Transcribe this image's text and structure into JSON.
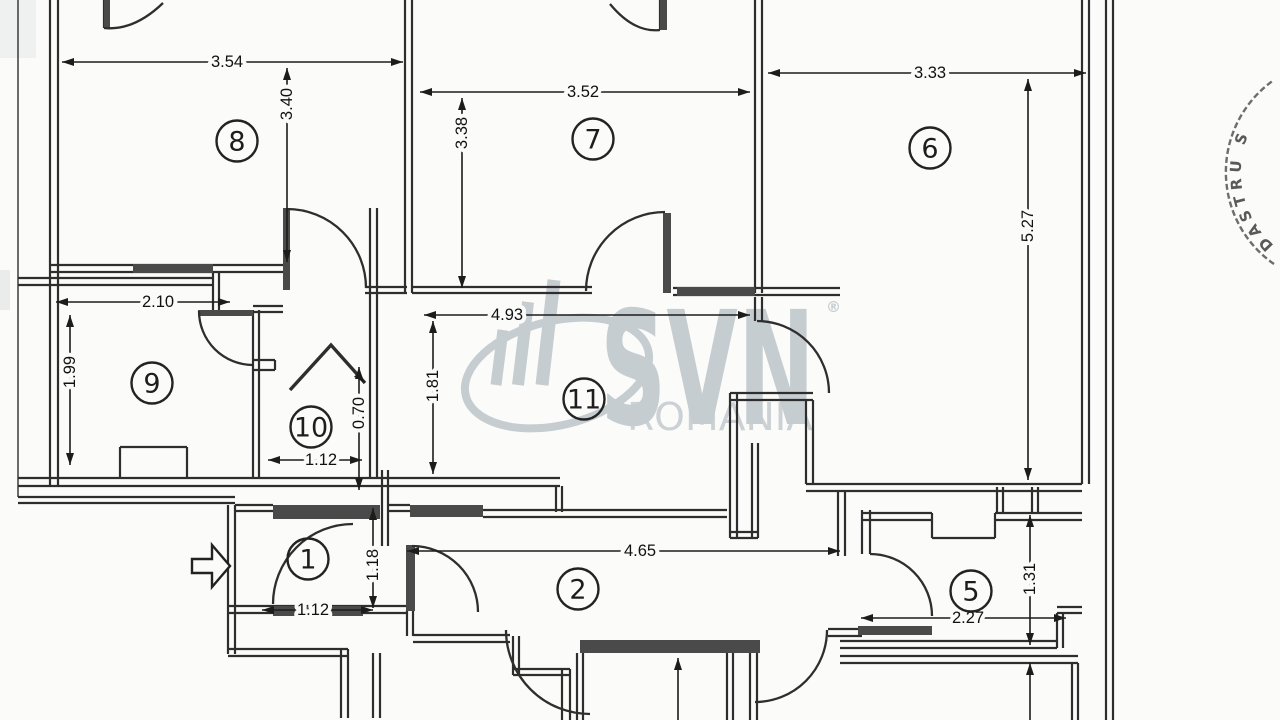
{
  "canvas": {
    "w": 1280,
    "h": 720,
    "bg": "#fbfbfa",
    "ink": "#2e2e2e"
  },
  "watermark": {
    "brand": "SVN",
    "reg": "®",
    "sub": "ROMANIA",
    "color": "#c6cdd0",
    "brand_x": 600,
    "brand_y": 424,
    "brand_size": 158,
    "brand_len": 215,
    "reg_x": 826,
    "reg_y": 312,
    "sub_x": 627,
    "sub_y": 430,
    "sub_size": 38,
    "sub_len": 186,
    "ellipse": {
      "cx": 557,
      "cy": 373,
      "rx": 94,
      "ry": 52,
      "rot": -14,
      "sw": 8
    },
    "bars": [
      [
        496,
        385,
        503,
        330,
        11
      ],
      [
        518,
        385,
        528,
        302,
        12
      ],
      [
        542,
        385,
        554,
        280,
        13
      ]
    ]
  },
  "stamp": {
    "text": "DASTRU S",
    "ring_d": "M1274,264 A112,112 0 0 1 1274,80",
    "text_d": "M1283,252 A97,97 0 0 1 1283,92",
    "color": "#4a4a4a"
  },
  "entry_arrow": {
    "d": "M192,559 L212,559 L212,545 L230,566 L212,587 L212,573 L192,573 Z"
  },
  "chevron": {
    "d": "M290,390 L331,345 L365,383"
  },
  "rooms": [
    {
      "n": "8",
      "x": 237,
      "y": 141
    },
    {
      "n": "7",
      "x": 593,
      "y": 139
    },
    {
      "n": "6",
      "x": 930,
      "y": 148
    },
    {
      "n": "9",
      "x": 152,
      "y": 383
    },
    {
      "n": "10",
      "x": 311,
      "y": 427
    },
    {
      "n": "11",
      "x": 584,
      "y": 399
    },
    {
      "n": "1",
      "x": 308,
      "y": 559
    },
    {
      "n": "2",
      "x": 578,
      "y": 589
    },
    {
      "n": "5",
      "x": 971,
      "y": 591
    }
  ],
  "dimensions": [
    {
      "t": "3.54",
      "x": 227,
      "y": 62,
      "rot": 0,
      "l": [
        62,
        62,
        403,
        62
      ],
      "e": "both"
    },
    {
      "t": "3.40",
      "x": 287,
      "y": 104,
      "rot": -90,
      "l": [
        287,
        68,
        287,
        262
      ],
      "e": "both"
    },
    {
      "t": "3.52",
      "x": 583,
      "y": 92,
      "rot": 0,
      "l": [
        420,
        92,
        750,
        92
      ],
      "e": "both"
    },
    {
      "t": "3.38",
      "x": 462,
      "y": 133,
      "rot": -90,
      "l": [
        462,
        98,
        462,
        288
      ],
      "e": "both"
    },
    {
      "t": "3.33",
      "x": 930,
      "y": 73,
      "rot": 0,
      "l": [
        768,
        73,
        1086,
        73
      ],
      "e": "both"
    },
    {
      "t": "5.27",
      "x": 1028,
      "y": 226,
      "rot": -90,
      "l": [
        1028,
        79,
        1028,
        480
      ],
      "e": "both"
    },
    {
      "t": "2.10",
      "x": 158,
      "y": 302,
      "rot": 0,
      "l": [
        56,
        302,
        230,
        302
      ],
      "e": "both"
    },
    {
      "t": "1.99",
      "x": 70,
      "y": 372,
      "rot": -90,
      "l": [
        70,
        315,
        70,
        465
      ],
      "e": "both"
    },
    {
      "t": "4.93",
      "x": 507,
      "y": 315,
      "rot": 0,
      "l": [
        424,
        315,
        750,
        315
      ],
      "e": "both"
    },
    {
      "t": "1.81",
      "x": 433,
      "y": 386,
      "rot": -90,
      "l": [
        433,
        321,
        433,
        474
      ],
      "e": "both"
    },
    {
      "t": "1.12",
      "x": 321,
      "y": 460,
      "rot": 0,
      "l": [
        268,
        460,
        362,
        460
      ],
      "e": "both"
    },
    {
      "t": "0.70",
      "x": 359,
      "y": 413,
      "rot": -90,
      "l": [
        359,
        367,
        359,
        490
      ],
      "e": "both"
    },
    {
      "t": "1.18",
      "x": 373,
      "y": 565,
      "rot": -90,
      "l": [
        373,
        508,
        373,
        608
      ],
      "e": "both"
    },
    {
      "t": "1.12",
      "x": 313,
      "y": 610,
      "rot": 0,
      "l": [
        262,
        610,
        373,
        610
      ],
      "e": "both"
    },
    {
      "t": "4.65",
      "x": 640,
      "y": 551,
      "rot": 0,
      "l": [
        407,
        551,
        840,
        551
      ],
      "e": "both"
    },
    {
      "t": "1.31",
      "x": 1030,
      "y": 579,
      "rot": -90,
      "l": [
        1030,
        515,
        1030,
        645
      ],
      "e": "both"
    },
    {
      "t": "2.27",
      "x": 968,
      "y": 618,
      "rot": 0,
      "l": [
        861,
        618,
        1066,
        618
      ],
      "e": "both"
    },
    {
      "t": "",
      "x": 0,
      "y": 0,
      "rot": 0,
      "l": [
        678,
        658,
        678,
        720
      ],
      "e": "start"
    },
    {
      "t": "",
      "x": 0,
      "y": 0,
      "rot": 0,
      "l": [
        1030,
        663,
        1030,
        720
      ],
      "e": "start"
    }
  ],
  "geometry": {
    "walls": [
      [
        18,
        0,
        18,
        497,
        1.4
      ],
      [
        50,
        0,
        50,
        486
      ],
      [
        58,
        0,
        58,
        486
      ],
      [
        405,
        0,
        405,
        293
      ],
      [
        412,
        0,
        412,
        293
      ],
      [
        755,
        0,
        755,
        293
      ],
      [
        762,
        0,
        762,
        293
      ],
      [
        1082,
        0,
        1082,
        484
      ],
      [
        1089,
        0,
        1089,
        484
      ],
      [
        1106,
        0,
        1106,
        720
      ],
      [
        1113,
        0,
        1113,
        720
      ],
      [
        213,
        272,
        213,
        312
      ],
      [
        219,
        272,
        219,
        312
      ],
      [
        253,
        310,
        253,
        478
      ],
      [
        259,
        310,
        259,
        478
      ],
      [
        370,
        208,
        370,
        478
      ],
      [
        377,
        208,
        377,
        478
      ],
      [
        755,
        297,
        755,
        321
      ],
      [
        762,
        297,
        762,
        321
      ],
      [
        730,
        393,
        730,
        538
      ],
      [
        737,
        393,
        737,
        538
      ],
      [
        752,
        443,
        752,
        538
      ],
      [
        758,
        443,
        758,
        538
      ],
      [
        806,
        400,
        806,
        484
      ],
      [
        813,
        400,
        813,
        484
      ],
      [
        556,
        486,
        556,
        512
      ],
      [
        562,
        486,
        562,
        512
      ],
      [
        382,
        470,
        382,
        546
      ],
      [
        388,
        470,
        388,
        546
      ],
      [
        228,
        505,
        228,
        654
      ],
      [
        235,
        505,
        235,
        654
      ],
      [
        407,
        610,
        407,
        636
      ],
      [
        413,
        610,
        413,
        636
      ],
      [
        373,
        653,
        373,
        718
      ],
      [
        380,
        653,
        380,
        718
      ],
      [
        341,
        649,
        341,
        718
      ],
      [
        348,
        649,
        348,
        718
      ],
      [
        513,
        636,
        513,
        675
      ],
      [
        519,
        636,
        519,
        675
      ],
      [
        562,
        669,
        562,
        720
      ],
      [
        570,
        669,
        570,
        720
      ],
      [
        577,
        653,
        577,
        720
      ],
      [
        583,
        653,
        583,
        720
      ],
      [
        727,
        653,
        727,
        720
      ],
      [
        733,
        653,
        733,
        720
      ],
      [
        750,
        653,
        750,
        720
      ],
      [
        757,
        653,
        757,
        720
      ],
      [
        838,
        491,
        838,
        556
      ],
      [
        845,
        491,
        845,
        556
      ],
      [
        862,
        510,
        862,
        554
      ],
      [
        870,
        510,
        870,
        554
      ],
      [
        932,
        513,
        932,
        538
      ],
      [
        995,
        513,
        995,
        538
      ],
      [
        997,
        487,
        997,
        513
      ],
      [
        1003,
        487,
        1003,
        513
      ],
      [
        1032,
        487,
        1032,
        513
      ],
      [
        1038,
        487,
        1038,
        513
      ],
      [
        1057,
        613,
        1057,
        648
      ],
      [
        1063,
        613,
        1063,
        648
      ],
      [
        1072,
        663,
        1072,
        720
      ],
      [
        1078,
        663,
        1078,
        720
      ],
      [
        120,
        447,
        120,
        478
      ],
      [
        187,
        447,
        187,
        478
      ],
      [
        275,
        360,
        275,
        370
      ],
      [
        104,
        0,
        104,
        28
      ],
      [
        660,
        0,
        660,
        30
      ],
      [
        50,
        265,
        285,
        265
      ],
      [
        50,
        272,
        285,
        272
      ],
      [
        18,
        278,
        213,
        278
      ],
      [
        18,
        285,
        213,
        285
      ],
      [
        365,
        287,
        407,
        287
      ],
      [
        365,
        293,
        407,
        293
      ],
      [
        412,
        287,
        592,
        287
      ],
      [
        412,
        293,
        592,
        293
      ],
      [
        673,
        288,
        840,
        288
      ],
      [
        673,
        295,
        840,
        295
      ],
      [
        253,
        306,
        283,
        306
      ],
      [
        253,
        312,
        283,
        312
      ],
      [
        18,
        478,
        560,
        478
      ],
      [
        18,
        486,
        560,
        486
      ],
      [
        18,
        497,
        235,
        497
      ],
      [
        18,
        503,
        235,
        503
      ],
      [
        120,
        447,
        187,
        447
      ],
      [
        253,
        360,
        275,
        360
      ],
      [
        253,
        370,
        275,
        370
      ],
      [
        235,
        505,
        273,
        505
      ],
      [
        235,
        511,
        273,
        511
      ],
      [
        388,
        505,
        410,
        505
      ],
      [
        388,
        511,
        410,
        511
      ],
      [
        483,
        510,
        727,
        510
      ],
      [
        483,
        517,
        727,
        517
      ],
      [
        730,
        393,
        813,
        393
      ],
      [
        730,
        400,
        813,
        400
      ],
      [
        730,
        532,
        758,
        532
      ],
      [
        730,
        538,
        758,
        538
      ],
      [
        806,
        484,
        1082,
        484
      ],
      [
        806,
        491,
        1082,
        491
      ],
      [
        862,
        513,
        932,
        513
      ],
      [
        862,
        520,
        932,
        520
      ],
      [
        932,
        538,
        995,
        538
      ],
      [
        995,
        513,
        1082,
        513
      ],
      [
        995,
        520,
        1082,
        520
      ],
      [
        228,
        606,
        407,
        606
      ],
      [
        228,
        613,
        407,
        613
      ],
      [
        413,
        635,
        510,
        635
      ],
      [
        413,
        642,
        510,
        642
      ],
      [
        513,
        669,
        570,
        669
      ],
      [
        513,
        675,
        570,
        675
      ],
      [
        228,
        649,
        348,
        649
      ],
      [
        228,
        656,
        348,
        656
      ],
      [
        828,
        629,
        862,
        629
      ],
      [
        828,
        636,
        862,
        636
      ],
      [
        840,
        641,
        1057,
        641
      ],
      [
        840,
        648,
        1057,
        648
      ],
      [
        840,
        656,
        1078,
        656
      ],
      [
        840,
        663,
        1078,
        663
      ],
      [
        1057,
        607,
        1082,
        607
      ],
      [
        1057,
        613,
        1082,
        613
      ]
    ],
    "bands": [
      [
        273,
        505,
        107,
        14
      ],
      [
        410,
        505,
        73,
        12
      ],
      [
        406,
        545,
        9,
        66
      ],
      [
        273,
        606,
        90,
        10
      ],
      [
        580,
        640,
        180,
        13
      ],
      [
        677,
        287,
        78,
        9
      ],
      [
        858,
        626,
        74,
        9
      ],
      [
        133,
        264,
        80,
        9
      ],
      [
        198,
        310,
        55,
        6
      ],
      [
        283,
        208,
        7,
        82
      ],
      [
        663,
        213,
        8,
        80
      ],
      [
        660,
        0,
        7,
        30
      ],
      [
        104,
        0,
        6,
        28
      ]
    ],
    "arcs": [
      "M104,28 Q134,31 163,3",
      "M660,30 Q634,33 610,4",
      "M586,291 A79,79 0 0 1 665,212",
      "M287,209 A79,79 0 0 1 366,288",
      "M199,311 A54,54 0 0 0 253,365",
      "M757,321 A72,72 0 0 1 829,393",
      "M353,524 A80,80 0 0 0 273,604",
      "M412,546 A66,66 0 0 1 478,612",
      "M506,630 A84,84 0 0 0 590,714",
      "M827,630 A72,72 0 0 1 755,702",
      "M870,554 A62,62 0 0 1 932,616"
    ],
    "smudges": [
      [
        0,
        0,
        36,
        58,
        "#e9ecec",
        0.7
      ],
      [
        0,
        270,
        10,
        40,
        "#dfe3e3",
        0.6
      ]
    ]
  }
}
